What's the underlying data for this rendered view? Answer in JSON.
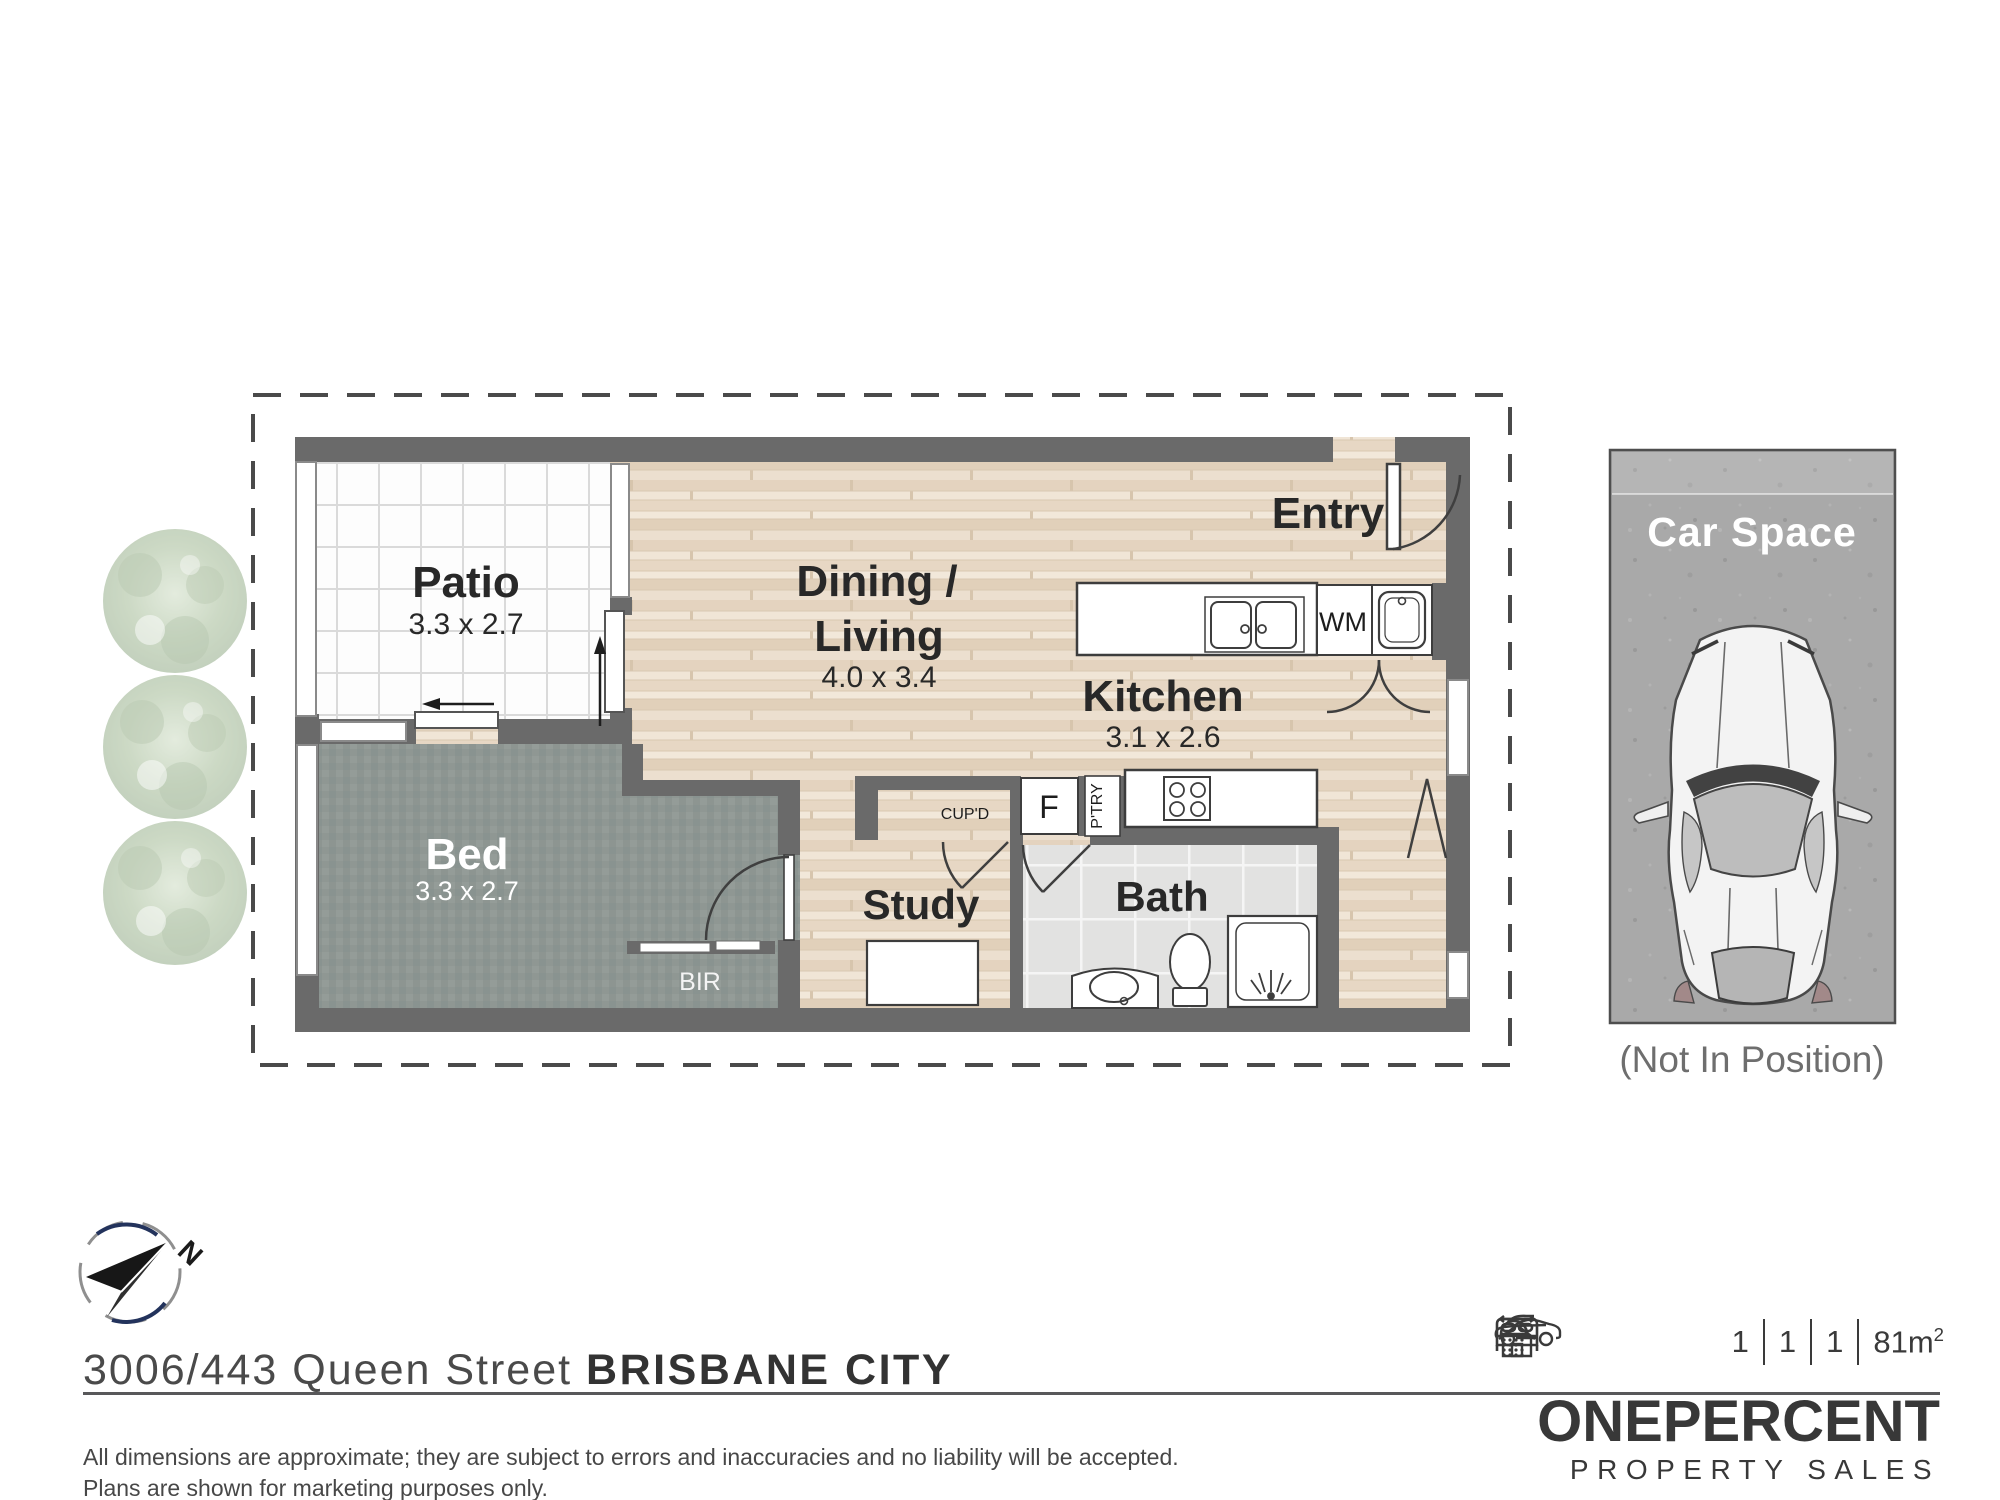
{
  "plan": {
    "patio": {
      "name": "Patio",
      "dims": "3.3 x 2.7"
    },
    "living": {
      "name1": "Dining /",
      "name2": "Living",
      "dims": "4.0 x 3.4"
    },
    "entry": {
      "name": "Entry"
    },
    "kitchen": {
      "name": "Kitchen",
      "dims": "3.1 x 2.6"
    },
    "bed": {
      "name": "Bed",
      "dims": "3.3 x 2.7"
    },
    "study": {
      "name": "Study"
    },
    "bath": {
      "name": "Bath"
    },
    "bir_label": "BIR",
    "wm_label": "WM",
    "fridge_label": "F",
    "pantry_label": "P'TRY",
    "cupboard_label": "CUP'D"
  },
  "car_space": {
    "title": "Car Space",
    "caption": "(Not In Position)"
  },
  "compass": {
    "north": "N"
  },
  "footer": {
    "address_street": "3006/443 Queen Street ",
    "address_suburb": "BRISBANE CITY",
    "stats": {
      "beds": "1",
      "baths": "1",
      "cars": "1",
      "area": "81m",
      "area_sup": "2"
    },
    "disclaimer_line1": "All dimensions are approximate; they are subject to errors and inaccuracies and no liability will be accepted.",
    "disclaimer_line2": "Plans are shown for marketing purposes only.",
    "brand_one": "ONE",
    "brand_percent": "PERCENT",
    "brand_sub": "PROPERTY SALES"
  },
  "colors": {
    "wall": "#6a6a6a",
    "wood_floor": "#eadcca",
    "carpet": "#8f9793",
    "bath_tile": "#e2e2e1",
    "patio_tile": "#fdfdfd",
    "concrete": "#aaaaaa",
    "compass_navy": "#23335c",
    "tree_green": "#aec3a2",
    "text_dark": "#282828"
  }
}
